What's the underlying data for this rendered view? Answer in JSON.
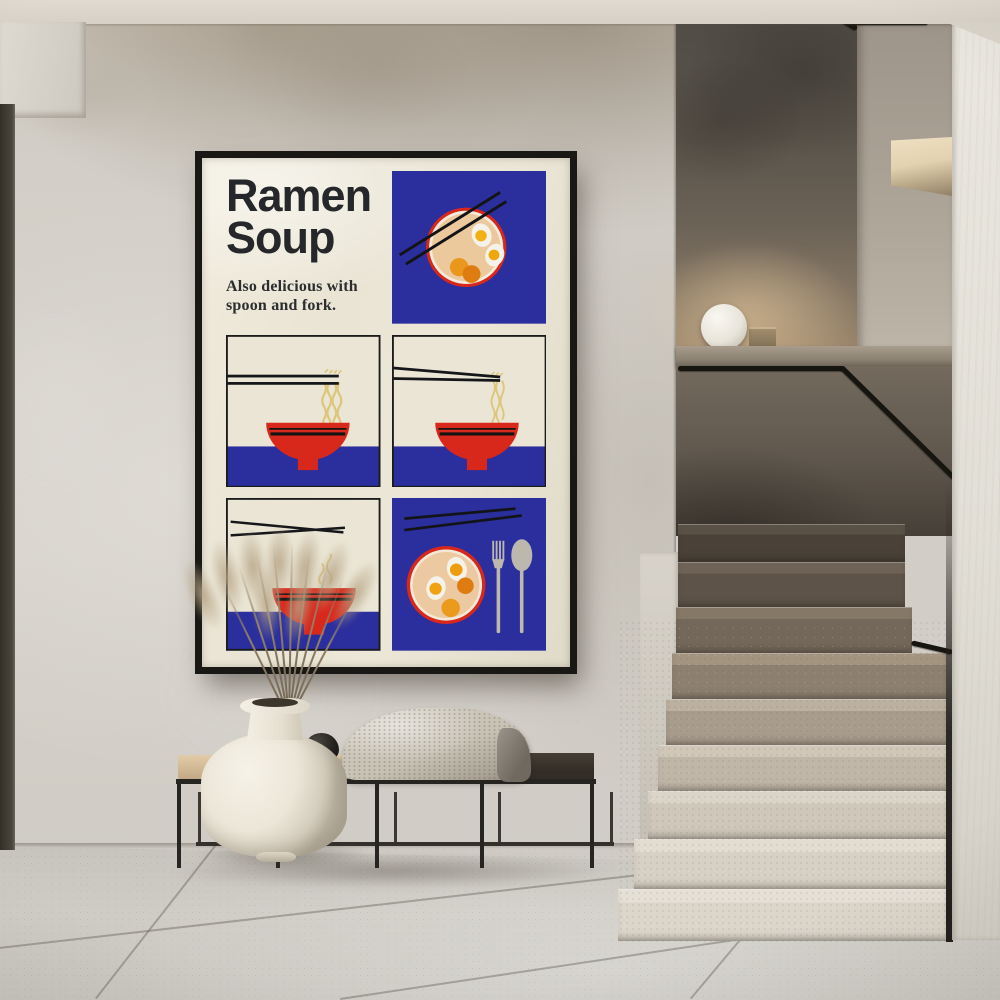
{
  "scene": {
    "setting": "hallway-interior-with-staircase",
    "wall_finish": "plaster",
    "floor_finish": "stone-tile"
  },
  "poster": {
    "title_line1": "Ramen",
    "title_line2": "Soup",
    "subtitle_line1": "Also delicious with",
    "subtitle_line2": "spoon and fork.",
    "frame_color": "#191814",
    "paper_color": "#e9e4d5",
    "palette": {
      "blue": "#2b2e9d",
      "red": "#d8281c",
      "broth": "#ecc89d",
      "egg_white": "#f5f2ea",
      "yolk": "#f0b016",
      "chashu_orange": "#e0851a",
      "noodle": "#ddc67a",
      "ink": "#25272a",
      "cutlery_gray": "#bcb8ad"
    },
    "panels": [
      {
        "id": "bowl-top-view-blue",
        "icons": [
          "chopsticks-icon",
          "ramen-bowl-top-icon",
          "boiled-egg-icon",
          "chashu-icon"
        ]
      },
      {
        "id": "noodle-pull-straight",
        "icons": [
          "chopsticks-icon",
          "noodles-icon",
          "red-bowl-icon"
        ]
      },
      {
        "id": "noodle-pull-angled",
        "icons": [
          "chopsticks-icon",
          "noodles-icon",
          "red-bowl-icon"
        ]
      },
      {
        "id": "steaming-bowl",
        "icons": [
          "chopsticks-icon",
          "steam-icon",
          "red-bowl-icon"
        ]
      },
      {
        "id": "bowl-top-view-cutlery",
        "icons": [
          "chopsticks-icon",
          "ramen-bowl-top-icon",
          "boiled-egg-icon",
          "chashu-icon",
          "fork-icon",
          "spoon-icon"
        ]
      }
    ]
  },
  "furniture": {
    "bench": {
      "frame_color": "#272522",
      "cushion_color": "#d6bd99",
      "dark_top_color": "#322d26",
      "items": [
        "knit-blanket",
        "black-stone-left",
        "black-stone-right"
      ]
    },
    "vase": {
      "color": "#ece6d8",
      "contents": "dried-pampas-grass"
    },
    "sphere_lamp": {
      "color": "#f2efe8"
    }
  },
  "staircase": {
    "handrail_color": "#17150f",
    "step_material": "terrazzo",
    "visible_steps": 9
  }
}
